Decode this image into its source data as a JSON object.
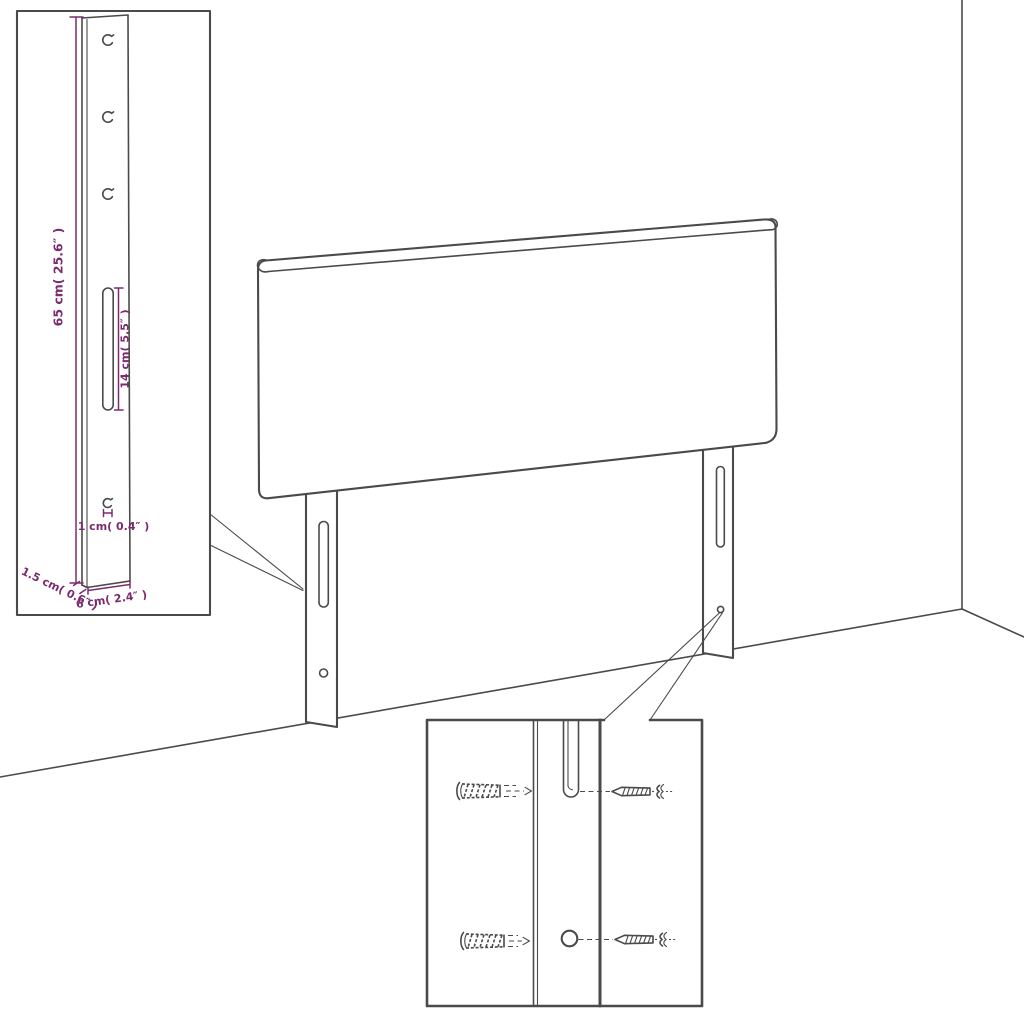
{
  "diagram": {
    "kind": "headboard-assembly-diagram",
    "colors": {
      "line": "#4a4a4a",
      "accent": "#7b2b6e",
      "background": "#ffffff"
    },
    "dimensions": {
      "leg_height": "65 cm( 25.6″ )",
      "slot_length": "14 cm( 5.5″ )",
      "hole_diameter": "1 cm( 0.4″ )",
      "leg_depth": "1.5 cm( 0.6″ )",
      "leg_width": "6 cm( 2.4″ )"
    },
    "icons": {
      "wall_plug": "wall-plug-icon",
      "screw": "screw-icon"
    }
  }
}
